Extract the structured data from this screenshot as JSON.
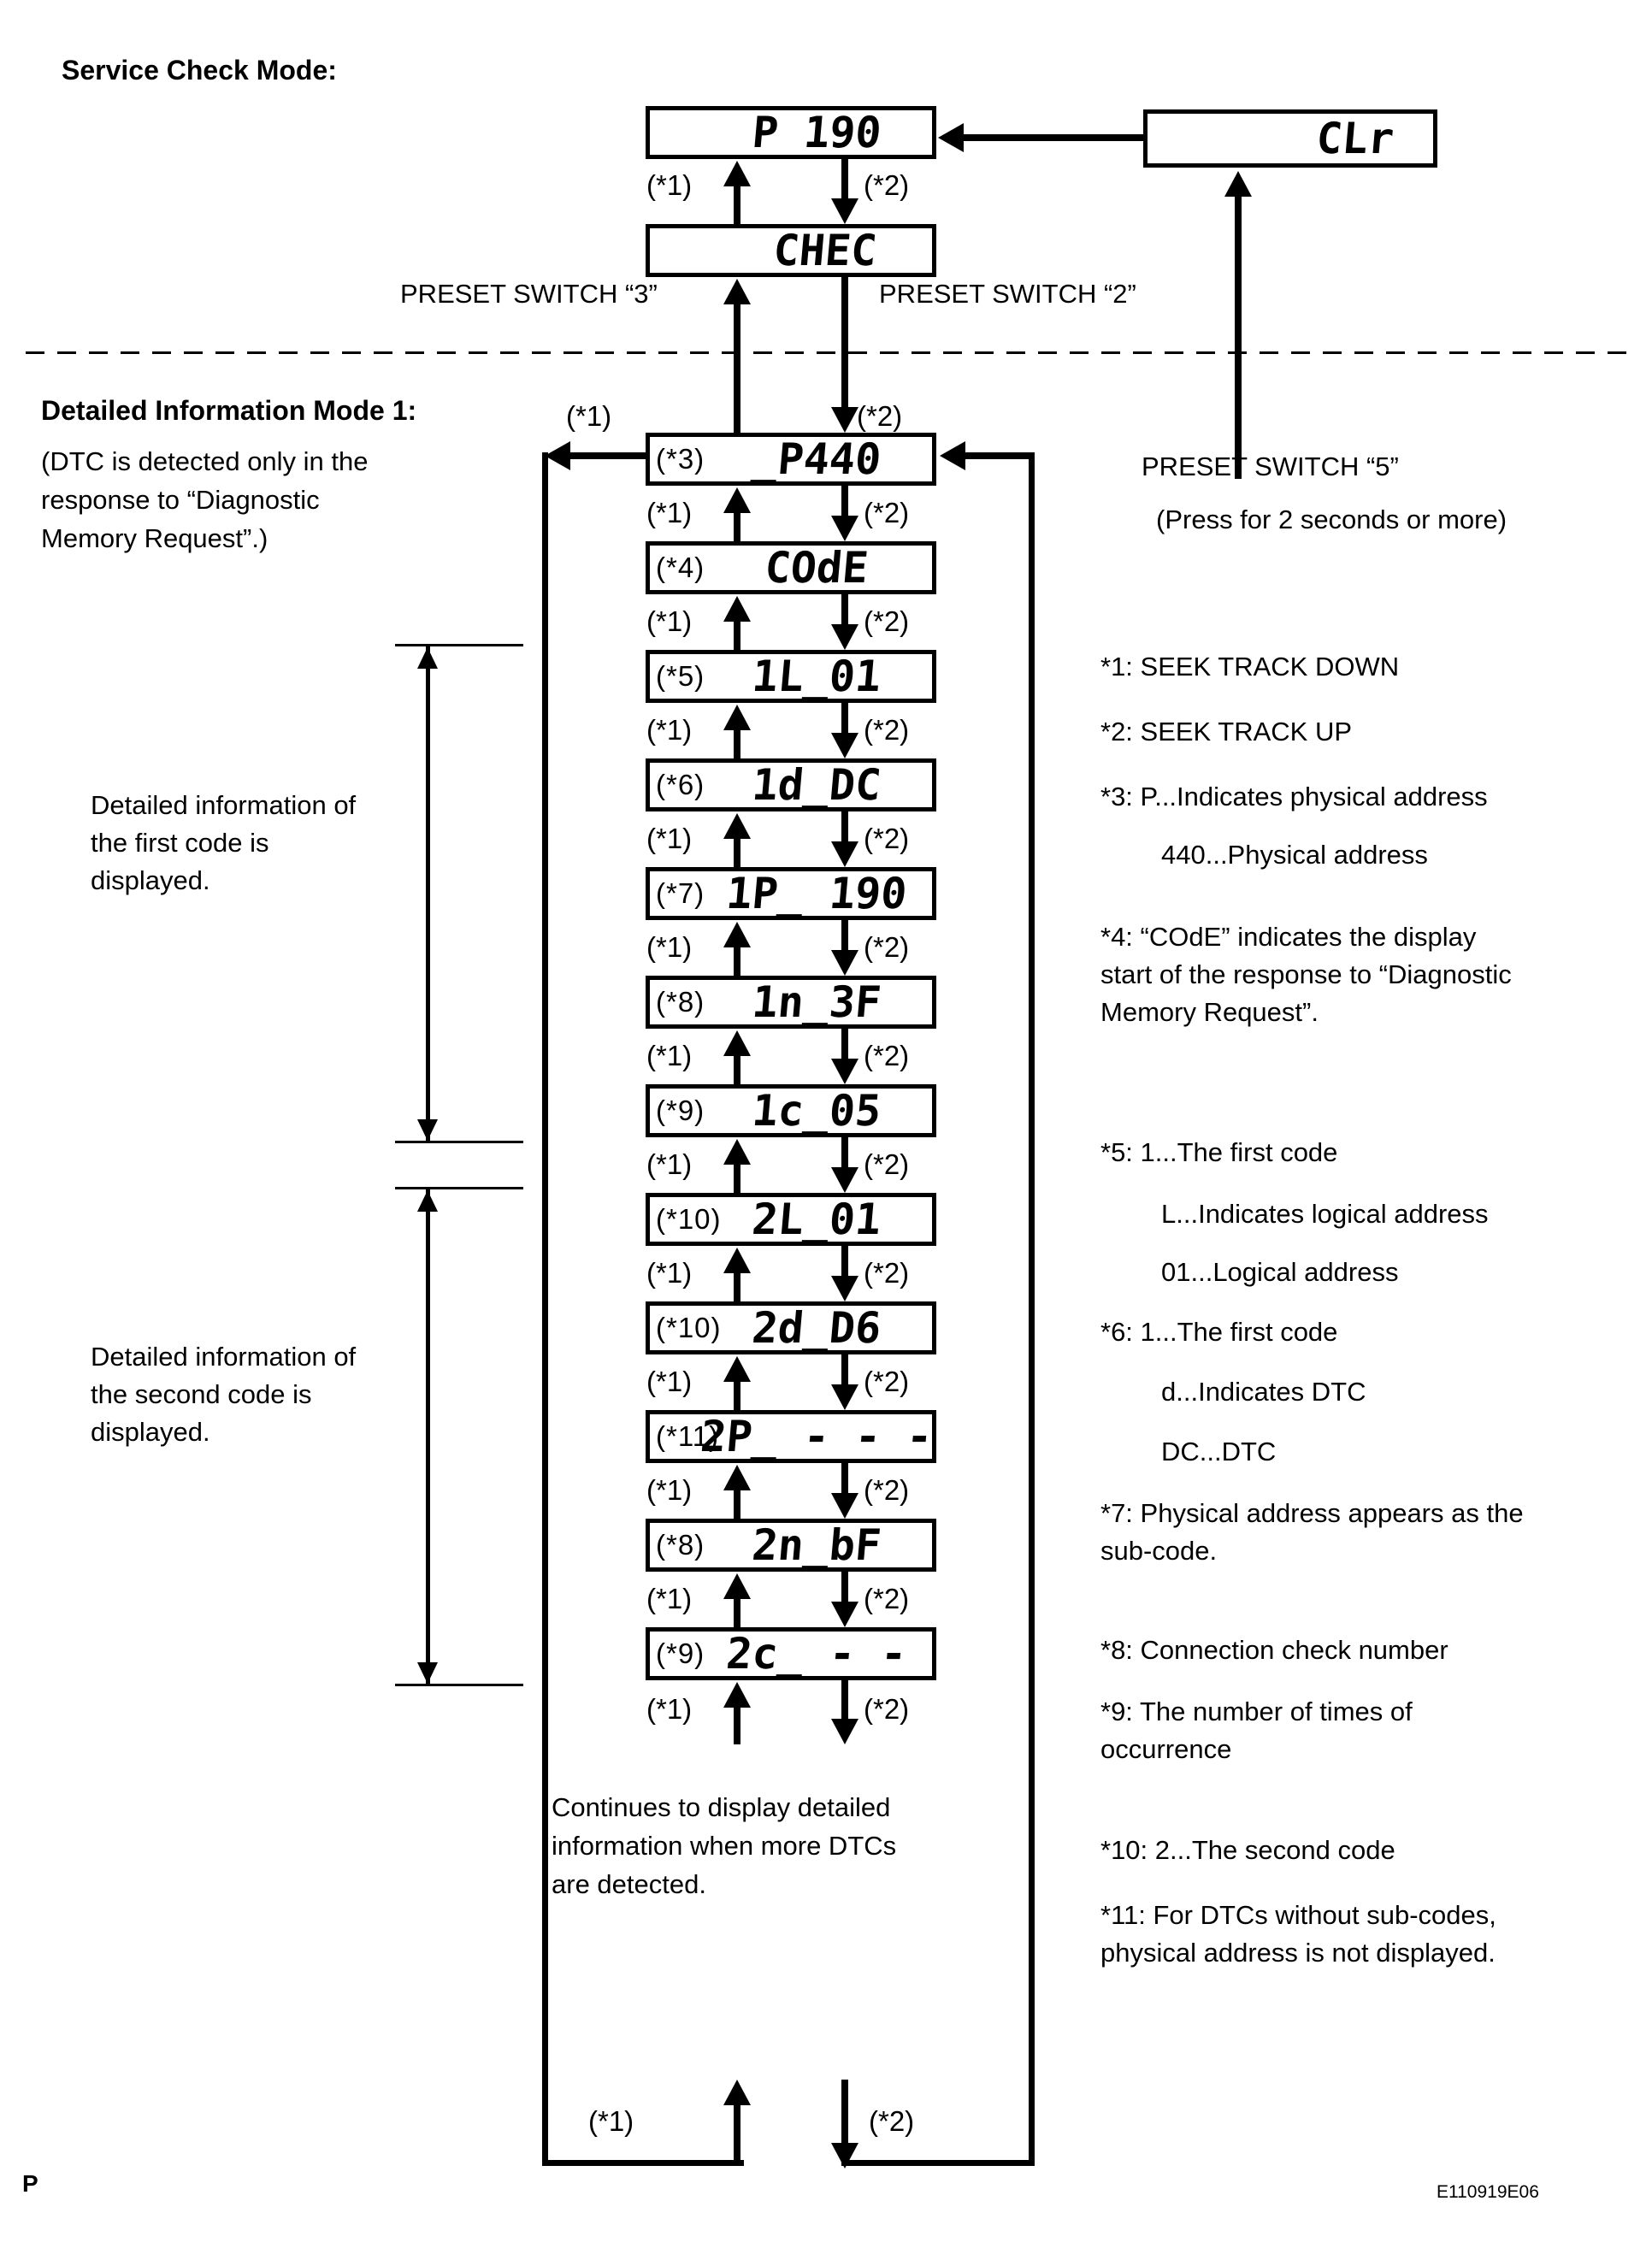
{
  "service_check_title": "Service Check Mode:",
  "detail_mode": {
    "title": "Detailed Information Mode 1:",
    "note": [
      "(DTC is detected only in the",
      "response to “Diagnostic",
      "Memory Request”.)"
    ]
  },
  "tags": {
    "t1": "(*1)",
    "t2": "(*2)"
  },
  "switch_labels": {
    "preset3": "PRESET SWITCH “3”",
    "preset2": "PRESET SWITCH “2”",
    "preset5": "PRESET SWITCH “5”",
    "preset5_note": "(Press for 2 seconds or more)"
  },
  "displays": {
    "p190": "P 190",
    "chec": "CHEC",
    "clr": "CLr"
  },
  "sequence": [
    {
      "tag": "(*3)",
      "display": "_P440"
    },
    {
      "tag": "(*4)",
      "display": "COdE"
    },
    {
      "tag": "(*5)",
      "display": "1L_01"
    },
    {
      "tag": "(*6)",
      "display": "1d_DC"
    },
    {
      "tag": "(*7)",
      "display": "1P_ 190"
    },
    {
      "tag": "(*8)",
      "display": "1n_3F"
    },
    {
      "tag": "(*9)",
      "display": "1c_05"
    },
    {
      "tag": "(*10)",
      "display": "2L_01"
    },
    {
      "tag": "(*10)",
      "display": "2d_D6"
    },
    {
      "tag": "(*11)",
      "display": "2P_ - - -"
    },
    {
      "tag": "(*8)",
      "display": "2n_bF"
    },
    {
      "tag": "(*9)",
      "display": "2c_ - -"
    }
  ],
  "side_notes": {
    "first_code": [
      "Detailed information of",
      "the first code is",
      "displayed."
    ],
    "second_code": [
      "Detailed information of",
      "the second code is",
      "displayed."
    ],
    "continues": [
      "Continues to display detailed",
      "information when more DTCs",
      "are detected."
    ]
  },
  "annotations": [
    "*1: SEEK TRACK DOWN",
    "*2: SEEK TRACK UP",
    "*3: P...Indicates physical address",
    "440...Physical address",
    "*4: “COdE” indicates the display",
    "start of the response to “Diagnostic",
    "Memory Request”.",
    "*5: 1...The first code",
    "L...Indicates logical address",
    "01...Logical address",
    "*6: 1...The first code",
    "d...Indicates DTC",
    "DC...DTC",
    "*7: Physical address appears as the",
    "sub-code.",
    "*8: Connection check number",
    "*9: The number of times of",
    "occurrence",
    "*10: 2...The second code",
    "*11: For DTCs without sub-codes,",
    "physical address is not displayed."
  ],
  "footer": {
    "page": "P",
    "doc_id": "E110919E06"
  }
}
